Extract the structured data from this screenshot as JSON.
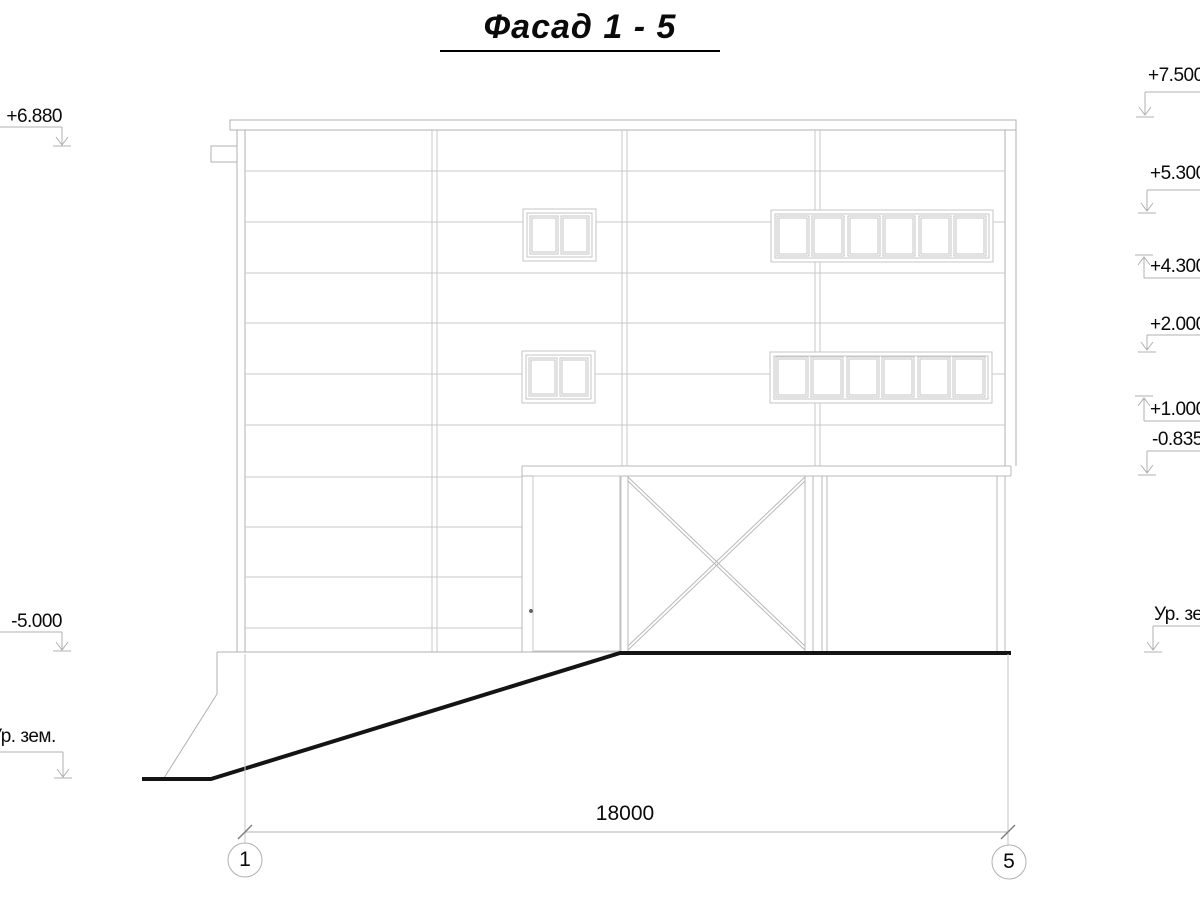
{
  "drawing": {
    "title": "Фасад 1 - 5",
    "left_marks": [
      {
        "label": "+6.880"
      },
      {
        "label": "-5.000"
      },
      {
        "label": "Ур. зем."
      }
    ],
    "right_marks": [
      {
        "label": "+7.500"
      },
      {
        "label": "+5.300"
      },
      {
        "label": "+4.300"
      },
      {
        "label": "+2.000"
      },
      {
        "label": "+1.000"
      },
      {
        "label": "-0.835"
      },
      {
        "label": "Ур. зем."
      }
    ],
    "dimension": {
      "length": "18000"
    },
    "axes": [
      {
        "label": "1"
      },
      {
        "label": "5"
      }
    ],
    "colors": {
      "outline": "#b0b0b0",
      "light_line": "#c9c9c9",
      "ground_line": "#141414",
      "text": "#0a0a0a"
    }
  }
}
